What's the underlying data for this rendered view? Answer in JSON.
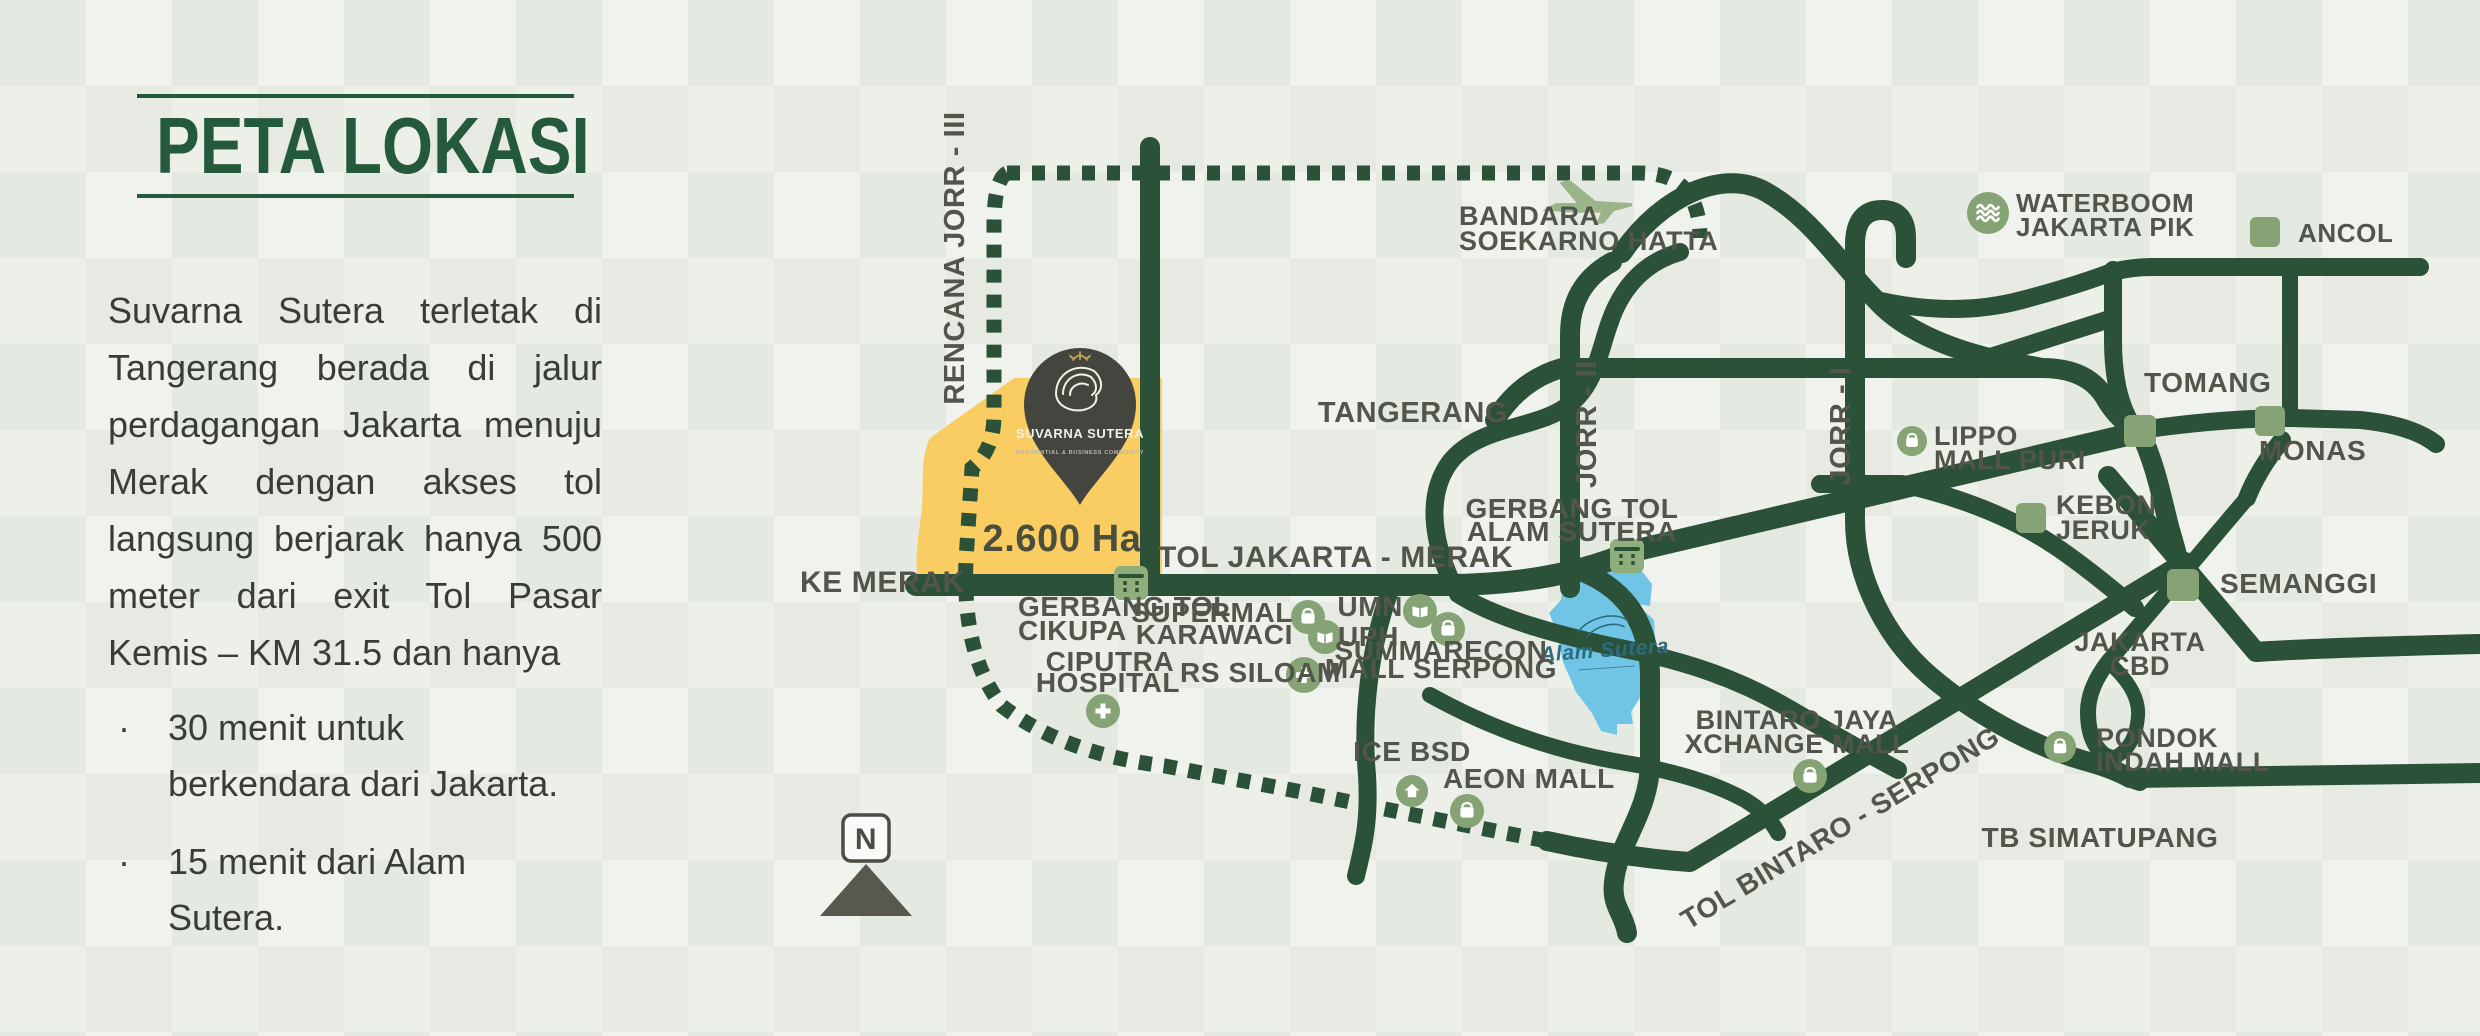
{
  "colors": {
    "background": "#e9ede5",
    "road": "#2b5138",
    "sage": "#85a374",
    "toll_bg": "#8fae7c",
    "plane": "#9cb489",
    "site_yellow": "#f9cd62",
    "alam_blue": "#70c5e6",
    "label": "#52554b",
    "title_green": "#24593c",
    "body_text": "#3a3d37",
    "pin_fill": "#45453f",
    "pin_gold": "#c3a857",
    "script_teal": "#2e6b7f"
  },
  "left_panel": {
    "title": "PETA LOKASI",
    "paragraph_lines": [
      "Suvarna Sutera terletak di",
      "Tangerang berada di jalur",
      "perdagangan Jakarta menuju",
      "Merak dengan akses tol",
      "langsung berjarak hanya 500",
      "meter dari exit Tol Pasar",
      "Kemis – KM 31.5 dan hanya"
    ],
    "bullets": [
      {
        "lines": [
          "30 menit untuk",
          "berkendara dari Jakarta."
        ]
      },
      {
        "lines": [
          "15 menit dari Alam",
          "Sutera."
        ]
      }
    ]
  },
  "map": {
    "areas": {
      "site": {
        "name": "suvarna-sutera-site-area",
        "d": "M930,438 L1014,378 L1162,378 L1162,588 L920,588 C912,562 920,532 922,505 C924,480 920,458 930,438 Z"
      },
      "alam_sutera": {
        "name": "alam-sutera-area",
        "d": "M1563,577 L1592,566 L1638,566 L1652,584 L1650,606 L1637,604 L1654,620 L1656,654 L1645,690 L1631,712 L1633,724 L1617,724 L1617,735 L1601,731 L1592,713 L1576,692 L1563,662 L1557,632 L1549,613 L1561,600 Z"
      }
    },
    "site_area_label": {
      "t": "2.600 Ha",
      "x": 1062,
      "y": 551,
      "s": 38,
      "a": "m",
      "c": "#494e3d"
    },
    "alam_script": {
      "text": "Alam Sutera",
      "x": 1605,
      "y": 657
    },
    "pin": {
      "x": 1080,
      "y": 402,
      "title": "SUVARNA SUTERA",
      "tagline": "RESIDENTIAL & BUSINESS COMMUNITY"
    },
    "compass": {
      "letter": "N",
      "x": 866,
      "y": 838
    },
    "roads_dashed": [
      {
        "d": "M1007,173 L1640,173 Q1700,173 1700,238",
        "w": 15
      },
      {
        "d": "M1007,173 Q994,180 994,225 L994,415 Q994,450 972,468 L966,560 Q962,655 1002,706 Q1064,754 1165,766 L1302,792 Q1437,820 1547,841",
        "w": 15
      }
    ],
    "roads_solid": [
      {
        "d": "M916,585 L1445,585 Q1555,585 1633,551 L2140,432",
        "w": 22
      },
      {
        "d": "M1150,147 L1150,585",
        "w": 20
      },
      {
        "d": "M1570,588 L1570,335 Q1570,285 1612,262",
        "w": 20
      },
      {
        "d": "M1572,568 C1625,585 1648,622 1650,672 L1650,762 C1650,812 1618,842 1614,882 C1611,906 1624,914 1627,933",
        "w": 20
      },
      {
        "d": "M1458,594 C1495,618 1560,636 1620,648 C1690,662 1740,680 1788,708 C1838,737 1872,756 1898,770",
        "w": 18
      },
      {
        "d": "M1430,695 Q1520,745 1620,762 Q1700,775 1745,800 Q1768,814 1778,833",
        "w": 16
      },
      {
        "d": "M1392,585 C1368,650 1362,720 1367,775 C1370,825 1362,850 1356,876",
        "w": 18
      },
      {
        "d": "M1547,841 Q1620,857 1690,862 L2185,562",
        "w": 20
      },
      {
        "d": "M1452,583 C1430,535 1428,492 1450,462 C1480,424 1538,430 1570,404 C1600,380 1600,340 1616,307 C1630,278 1652,260 1680,252",
        "w": 18
      },
      {
        "d": "M1622,253 C1662,195 1724,168 1766,192 C1812,218 1840,264 1876,300 C1904,331 1952,350 2002,361 Q2022,364 2042,368",
        "w": 20
      },
      {
        "d": "M1495,420 Q1520,380 1562,368 L2042,368 Q2086,368 2104,396 Q2120,424 2140,430",
        "w": 20
      },
      {
        "d": "M1876,300 Q1955,318 2022,300 Q2075,286 2112,272 Q2132,267 2152,267",
        "w": 18
      },
      {
        "d": "M2152,267 L2420,267",
        "w": 18
      },
      {
        "d": "M2113,270 L2113,340 Q2113,395 2132,425",
        "w": 18
      },
      {
        "d": "M1962,366 Q2060,335 2113,318",
        "w": 18
      },
      {
        "d": "M2290,267 L2290,418",
        "w": 16
      },
      {
        "d": "M2140,430 Q2225,418 2292,418 L2360,420 Q2412,425 2436,444",
        "w": 18
      },
      {
        "d": "M2140,432 C2156,465 2162,500 2170,530 Q2176,550 2183,578",
        "w": 20
      },
      {
        "d": "M2108,476 L2256,652 Q2312,648 2480,644",
        "w": 20
      },
      {
        "d": "M2247,498 Q2258,470 2282,440",
        "w": 18
      },
      {
        "d": "M2247,498 L2108,662 Q2088,688 2088,712 C2088,744 2102,756 2112,758",
        "w": 16
      },
      {
        "d": "M2108,662 Q2140,690 2138,716 C2136,744 2122,755 2112,758",
        "w": 14
      },
      {
        "d": "M2112,758 Q2112,775 2140,783",
        "w": 16
      },
      {
        "d": "M1820,484 L1902,484 Q1995,505 2058,548 Q2090,570 2135,608",
        "w": 18
      },
      {
        "d": "M1855,470 L1855,245 Q1855,210 1882,210 Q1906,210 1906,238 L1906,258",
        "w": 20
      },
      {
        "d": "M1855,470 L1855,520 C1855,580 1888,640 1930,676 C1972,712 2030,745 2082,760 Q2112,768 2130,778",
        "w": 20
      },
      {
        "d": "M2130,778 L2480,773",
        "w": 20
      }
    ],
    "toll_gates": [
      {
        "name": "gerbang-tol-cikupa-gate",
        "x": 1131,
        "y": 583,
        "s": 34
      },
      {
        "name": "gerbang-tol-alam-sutera-gate",
        "x": 1627,
        "y": 556,
        "s": 34
      }
    ],
    "squares": [
      {
        "name": "ancol",
        "x": 2265,
        "y": 232,
        "s": 30
      },
      {
        "name": "tomang",
        "x": 2140,
        "y": 431,
        "s": 32
      },
      {
        "name": "monas",
        "x": 2270,
        "y": 421,
        "s": 30
      },
      {
        "name": "kebon-jeruk",
        "x": 2031,
        "y": 518,
        "s": 30
      },
      {
        "name": "semanggi",
        "x": 2183,
        "y": 585,
        "s": 32
      }
    ],
    "icons": [
      {
        "k": "waves",
        "name": "waterboom",
        "x": 1988,
        "y": 213,
        "s": 42
      },
      {
        "k": "bag",
        "name": "lippo-mall-puri",
        "x": 1912,
        "y": 441,
        "s": 30
      },
      {
        "k": "bag",
        "name": "supermal-karawaci",
        "x": 1308,
        "y": 617,
        "s": 34
      },
      {
        "k": "bag",
        "name": "summarecon-mall-serpong",
        "x": 1448,
        "y": 629,
        "s": 34
      },
      {
        "k": "bag",
        "name": "aeon-mall",
        "x": 1467,
        "y": 811,
        "s": 34
      },
      {
        "k": "bag",
        "name": "bintaro-jaya-xchange-mall",
        "x": 1810,
        "y": 776,
        "s": 34
      },
      {
        "k": "bag",
        "name": "pondok-indah-mall",
        "x": 2060,
        "y": 747,
        "s": 32
      },
      {
        "k": "book",
        "name": "umn",
        "x": 1420,
        "y": 611,
        "s": 34
      },
      {
        "k": "book",
        "name": "uph",
        "x": 1325,
        "y": 637,
        "s": 34
      },
      {
        "k": "cross",
        "name": "rs-siloam",
        "x": 1304,
        "y": 675,
        "s": 36
      },
      {
        "k": "cross",
        "name": "ciputra-hospital",
        "x": 1103,
        "y": 711,
        "s": 34
      },
      {
        "k": "house",
        "name": "ice-bsd",
        "x": 1412,
        "y": 791,
        "s": 32
      }
    ],
    "plane": {
      "x": 1586,
      "y": 205
    },
    "labels": [
      {
        "t": "RENCANA JORR - III",
        "x": 964,
        "y": 258,
        "s": 29,
        "a": "m",
        "r": -90
      },
      {
        "t": "TOL JAKARTA - MERAK",
        "x": 1158,
        "y": 567,
        "s": 30,
        "a": "s"
      },
      {
        "t": "KE MERAK",
        "x": 800,
        "y": 592,
        "s": 30,
        "a": "s"
      },
      {
        "t": "GERBANG TOL",
        "x": 1018,
        "y": 616,
        "s": 28,
        "a": "s"
      },
      {
        "t": "CIKUPA",
        "x": 1018,
        "y": 640,
        "s": 28,
        "a": "s"
      },
      {
        "t": "CIPUTRA",
        "x": 1110,
        "y": 671,
        "s": 28,
        "a": "m"
      },
      {
        "t": "HOSPITAL",
        "x": 1108,
        "y": 692,
        "s": 28,
        "a": "m"
      },
      {
        "t": "SUPERMAL",
        "x": 1293,
        "y": 622,
        "s": 28,
        "a": "e"
      },
      {
        "t": "KARAWACI",
        "x": 1293,
        "y": 644,
        "s": 28,
        "a": "e"
      },
      {
        "t": "RS SILOAM",
        "x": 1180,
        "y": 682,
        "s": 28,
        "a": "s"
      },
      {
        "t": "UMN",
        "x": 1403,
        "y": 616,
        "s": 28,
        "a": "e"
      },
      {
        "t": "UPH",
        "x": 1338,
        "y": 646,
        "s": 28,
        "a": "s"
      },
      {
        "t": "SUMMARECON",
        "x": 1441,
        "y": 660,
        "s": 28,
        "a": "m"
      },
      {
        "t": "MALL SERPONG",
        "x": 1441,
        "y": 678,
        "s": 28,
        "a": "m"
      },
      {
        "t": "ICE BSD",
        "x": 1412,
        "y": 761,
        "s": 28,
        "a": "m"
      },
      {
        "t": "AEON MALL",
        "x": 1443,
        "y": 788,
        "s": 28,
        "a": "s"
      },
      {
        "t": "TANGERANG",
        "x": 1413,
        "y": 422,
        "s": 29,
        "a": "m"
      },
      {
        "t": "GERBANG TOL",
        "x": 1572,
        "y": 518,
        "s": 28,
        "a": "m"
      },
      {
        "t": "ALAM SUTERA",
        "x": 1572,
        "y": 541,
        "s": 28,
        "a": "m"
      },
      {
        "t": "JORR - II",
        "x": 1596,
        "y": 424,
        "s": 29,
        "a": "m",
        "r": -90
      },
      {
        "t": "JORR - I",
        "x": 1850,
        "y": 426,
        "s": 29,
        "a": "m",
        "r": -90
      },
      {
        "t": "BANDARA",
        "x": 1459,
        "y": 225,
        "s": 27,
        "a": "s"
      },
      {
        "t": "SOEKARNO HATTA",
        "x": 1459,
        "y": 250,
        "s": 27,
        "a": "s"
      },
      {
        "t": "WATERBOOM",
        "x": 2016,
        "y": 212,
        "s": 26,
        "a": "s"
      },
      {
        "t": "JAKARTA PIK",
        "x": 2016,
        "y": 236,
        "s": 26,
        "a": "s"
      },
      {
        "t": "ANCOL",
        "x": 2298,
        "y": 242,
        "s": 26,
        "a": "s"
      },
      {
        "t": "TOMANG",
        "x": 2144,
        "y": 392,
        "s": 28,
        "a": "s"
      },
      {
        "t": "MONAS",
        "x": 2259,
        "y": 460,
        "s": 28,
        "a": "s"
      },
      {
        "t": "LIPPO",
        "x": 1934,
        "y": 445,
        "s": 27,
        "a": "s"
      },
      {
        "t": "MALL PURI",
        "x": 1934,
        "y": 469,
        "s": 27,
        "a": "s"
      },
      {
        "t": "KEBON",
        "x": 2056,
        "y": 514,
        "s": 27,
        "a": "s"
      },
      {
        "t": "JERUK",
        "x": 2056,
        "y": 539,
        "s": 27,
        "a": "s"
      },
      {
        "t": "SEMANGGI",
        "x": 2220,
        "y": 593,
        "s": 28,
        "a": "s"
      },
      {
        "t": "JAKARTA",
        "x": 2140,
        "y": 651,
        "s": 27,
        "a": "m"
      },
      {
        "t": "CBD",
        "x": 2140,
        "y": 675,
        "s": 27,
        "a": "m"
      },
      {
        "t": "PONDOK",
        "x": 2096,
        "y": 747,
        "s": 27,
        "a": "s"
      },
      {
        "t": "INDAH MALL",
        "x": 2096,
        "y": 771,
        "s": 27,
        "a": "s"
      },
      {
        "t": "TB SIMATUPANG",
        "x": 2100,
        "y": 847,
        "s": 28,
        "a": "m"
      },
      {
        "t": "BINTARO JAYA",
        "x": 1797,
        "y": 729,
        "s": 27,
        "a": "m"
      },
      {
        "t": "XCHANGE MALL",
        "x": 1797,
        "y": 753,
        "s": 27,
        "a": "m"
      },
      {
        "t": "TOL BINTARO - SERPONG",
        "x": 1845,
        "y": 836,
        "s": 28,
        "a": "m",
        "r": -31
      }
    ]
  }
}
